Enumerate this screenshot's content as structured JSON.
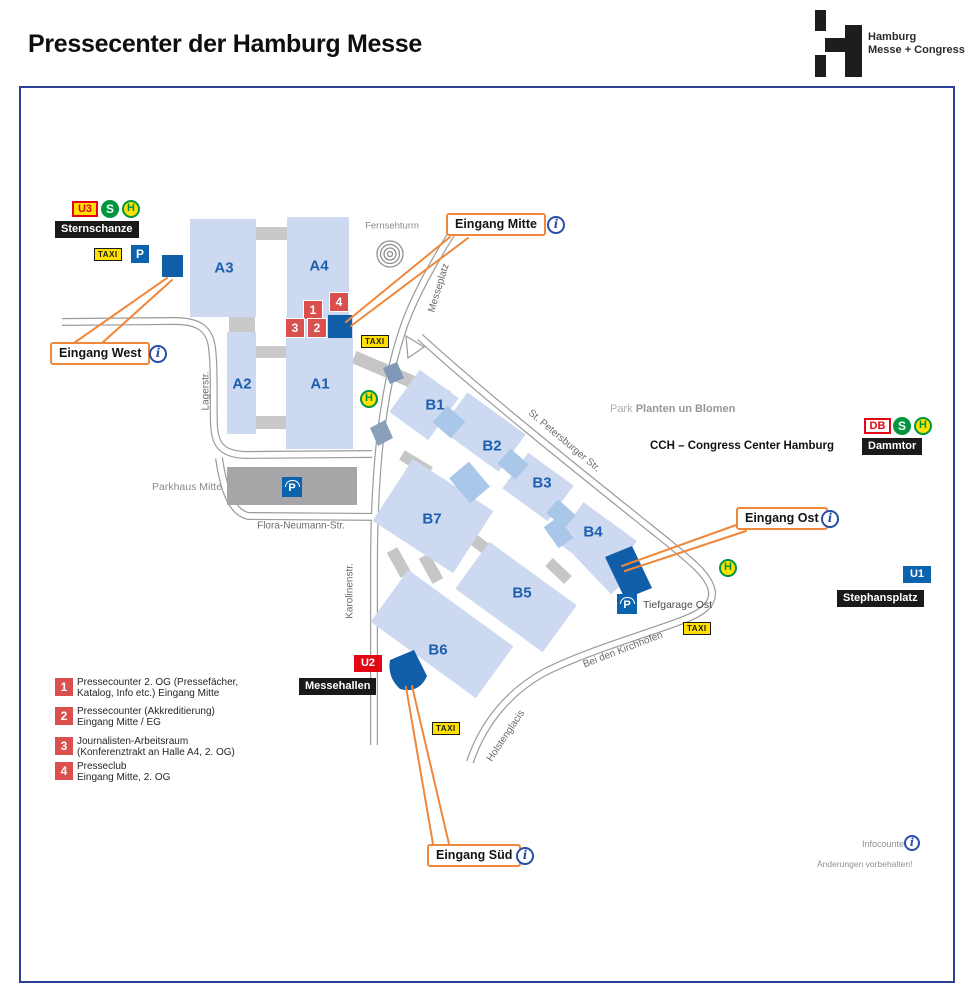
{
  "page": {
    "title": "Pressecenter der Hamburg Messe"
  },
  "logo": {
    "line1": "Hamburg",
    "line2": "Messe + Congress"
  },
  "badges": {
    "u3": "U3",
    "s": "S",
    "h": "H",
    "taxi": "TAXI",
    "p": "P",
    "db": "DB",
    "u1": "U1",
    "u2": "U2"
  },
  "stations": {
    "sternschanze": "Sternschanze",
    "dammtor": "Dammtor",
    "stephansplatz": "Stephansplatz",
    "messehallen": "Messehallen"
  },
  "halls": {
    "a1": "A1",
    "a2": "A2",
    "a3": "A3",
    "a4": "A4",
    "b1": "B1",
    "b2": "B2",
    "b3": "B3",
    "b4": "B4",
    "b5": "B5",
    "b6": "B6",
    "b7": "B7"
  },
  "streets": {
    "messeplatz": "Messeplatz",
    "lagerstr": "Lagerstr.",
    "karolinenstr": "Karolinenstr.",
    "flora": "Flora-Neumann-Str.",
    "petersburger": "St. Petersburger Str.",
    "kirchhoefen": "Bei den Kirchhöfen",
    "holstenglacis": "Holstenglacis"
  },
  "entrances": {
    "west": "Eingang West",
    "mitte": "Eingang Mitte",
    "ost": "Eingang Ost",
    "sued": "Eingang Süd"
  },
  "markers": {
    "m1": "1",
    "m2": "2",
    "m3": "3",
    "m4": "4"
  },
  "legend": {
    "items": [
      {
        "num": "1",
        "line1": "Pressecounter 2. OG (Pressefächer,",
        "line2": "Katalog, Info etc.) Eingang Mitte"
      },
      {
        "num": "2",
        "line1": "Pressecounter (Akkreditierung)",
        "line2": "Eingang Mitte / EG"
      },
      {
        "num": "3",
        "line1": "Journalisten-Arbeitsraum",
        "line2": "(Konferenztrakt an Halle A4, 2. OG)"
      },
      {
        "num": "4",
        "line1": "Presseclub",
        "line2": "Eingang Mitte, 2. OG"
      }
    ]
  },
  "poi": {
    "fernsehturm": "Fernsehturm",
    "parkhaus": "Parkhaus Mitte",
    "tiefgarage": "Tiefgarage Ost",
    "park_prefix": "Park",
    "park_name": "Planten un Blomen",
    "cch": "CCH – Congress Center Hamburg",
    "infocounter": "Infocounter",
    "disclaimer": "Änderungen vorbehalten!"
  },
  "icons": {
    "info_glyph": "i"
  },
  "colors": {
    "accent_orange": "#f0873a",
    "hall_fill": "#ccd9f1",
    "hall_text": "#1d5fae",
    "entrance_blue": "#115ea8",
    "marker_red": "#d9504e",
    "road_gray": "#9b9b9b",
    "frame_blue": "#2c3e94"
  }
}
